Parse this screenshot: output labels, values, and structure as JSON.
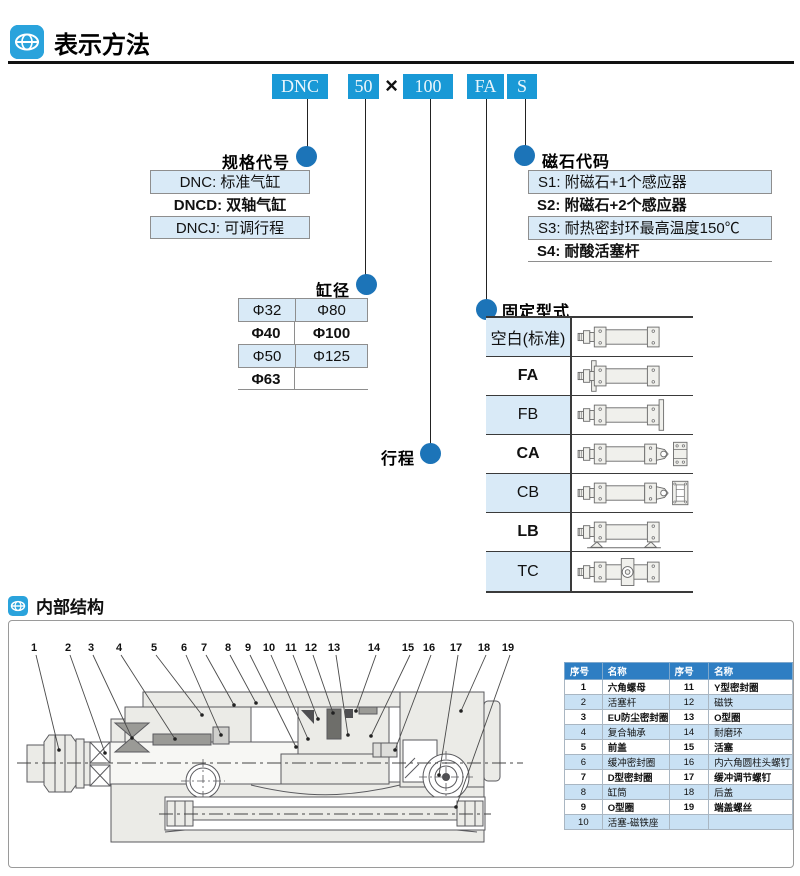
{
  "header": {
    "title": "表示方法",
    "icon": "brand-globe-icon"
  },
  "model_code": {
    "series": "DNC",
    "bore": "50",
    "multiply_sign": "×",
    "stroke": "100",
    "mount": "FA",
    "magnet": "S"
  },
  "spec_table": {
    "label": "规格代号",
    "rows": [
      {
        "text": "DNC: 标准气缸",
        "bold": false,
        "light": true
      },
      {
        "text": "DNCD: 双轴气缸",
        "bold": true,
        "light": false
      },
      {
        "text": "DNCJ: 可调行程",
        "bold": false,
        "light": true
      }
    ]
  },
  "magnet_table": {
    "label": "磁石代码",
    "rows": [
      {
        "text": "S1: 附磁石+1个感应器",
        "bold": false,
        "light": true
      },
      {
        "text": "S2: 附磁石+2个感应器",
        "bold": true,
        "light": false
      },
      {
        "text": "S3: 耐热密封环最高温度150℃",
        "bold": false,
        "light": true
      },
      {
        "text": "S4: 耐酸活塞杆",
        "bold": true,
        "light": false
      }
    ]
  },
  "bore_table": {
    "label": "缸径",
    "rows": [
      {
        "c1": "Φ32",
        "c2": "Φ80",
        "bold": false,
        "light": true
      },
      {
        "c1": "Φ40",
        "c2": "Φ100",
        "bold": true,
        "light": false
      },
      {
        "c1": "Φ50",
        "c2": "Φ125",
        "bold": false,
        "light": true
      },
      {
        "c1": "Φ63",
        "c2": "",
        "bold": true,
        "light": false
      }
    ]
  },
  "stroke_label": "行程",
  "mount_table": {
    "label": "固定型式",
    "rows": [
      {
        "code": "空白(标准)",
        "type": "blank",
        "bold": false,
        "light": true
      },
      {
        "code": "FA",
        "type": "fa",
        "bold": true,
        "light": false
      },
      {
        "code": "FB",
        "type": "fb",
        "bold": false,
        "light": true
      },
      {
        "code": "CA",
        "type": "ca",
        "bold": true,
        "light": false
      },
      {
        "code": "CB",
        "type": "cb",
        "bold": false,
        "light": true
      },
      {
        "code": "LB",
        "type": "lb",
        "bold": true,
        "light": false
      },
      {
        "code": "TC",
        "type": "tc",
        "bold": false,
        "light": true
      }
    ]
  },
  "section": {
    "title": "内部结构",
    "icon": "brand-globe-icon"
  },
  "diagram": {
    "callouts": [
      "1",
      "2",
      "3",
      "4",
      "5",
      "6",
      "7",
      "8",
      "9",
      "10",
      "11",
      "12",
      "13",
      "14",
      "15",
      "16",
      "17",
      "18",
      "19"
    ]
  },
  "parts_table": {
    "headers": [
      "序号",
      "名称",
      "序号",
      "名称"
    ],
    "rows": [
      [
        "1",
        "六角螺母",
        "11",
        "Y型密封圈"
      ],
      [
        "2",
        "活塞杆",
        "12",
        "磁铁"
      ],
      [
        "3",
        "EU防尘密封圈",
        "13",
        "O型圈"
      ],
      [
        "4",
        "复合轴承",
        "14",
        "耐磨环"
      ],
      [
        "5",
        "前盖",
        "15",
        "活塞"
      ],
      [
        "6",
        "缓冲密封圈",
        "16",
        "内六角圆柱头螺钉"
      ],
      [
        "7",
        "D型密封圈",
        "17",
        "缓冲调节螺钉"
      ],
      [
        "8",
        "缸筒",
        "18",
        "后盖"
      ],
      [
        "9",
        "O型圈",
        "19",
        "端盖螺丝"
      ],
      [
        "10",
        "活塞-磁铁座",
        "",
        ""
      ]
    ]
  },
  "colors": {
    "code_box_blue": "#1999d6",
    "dot_blue": "#1c74b8",
    "row_light_blue": "#d9eaf7",
    "parts_header_blue": "#2e7ec3",
    "parts_row_blue": "#c9e1f4",
    "icon_blue": "#2aa3dc"
  }
}
